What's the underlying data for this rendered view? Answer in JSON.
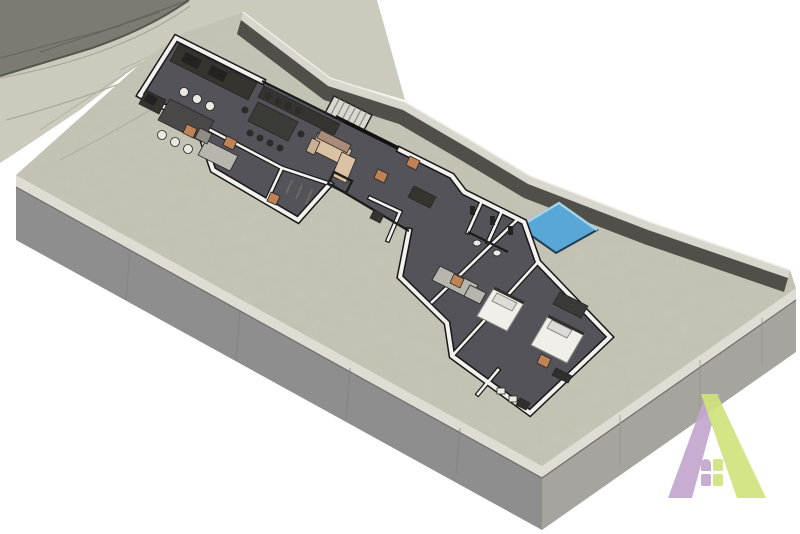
{
  "scene": {
    "type": "3d-floor-plan-render",
    "view": "axonometric",
    "elements": [
      "terrain-road",
      "terrain-slope",
      "driveway",
      "plot-slab",
      "boundary-wall",
      "house-floor-plan",
      "swimming-pool",
      "company-logo"
    ],
    "rooms": [
      "kitchen",
      "dining-area",
      "living-area",
      "pantry-utility",
      "glass-cellar",
      "stairs",
      "hall",
      "wc",
      "shower-rooms",
      "vanity-bathroom",
      "bedroom-1",
      "bedroom-2",
      "en-suite"
    ],
    "furniture": [
      "kitchen-counter",
      "kitchen-island",
      "bar-stools",
      "dining-table",
      "dining-chairs",
      "sofa",
      "coffee-table",
      "beds",
      "pillows",
      "benches",
      "wardrobe",
      "vanity-counter",
      "shower-columns",
      "toilets"
    ]
  },
  "colors": {
    "background": "#ffffff",
    "terrain_road": "#7b7a73",
    "terrain_light": "#cbcabc",
    "slab_top": "#c5c4b5",
    "slab_face_left": "#8f8e8f",
    "slab_face_right": "#a5a49f",
    "slab_lip": "#dedcd3",
    "wall_face": "#504f4a",
    "wall_top": "#d9d7cd",
    "house_floor": "#545359",
    "wall_white": "#f2f1ed",
    "wall_outline": "#171717",
    "counter_dark": "#35342f",
    "appliance_dark": "#222220",
    "furniture_grey": "#4a4947",
    "table_dark": "#3b3b38",
    "chair_dark": "#2c2c2a",
    "stool_seat": "#ebe8e1",
    "stairs_light": "#d9d7cf",
    "sofa_tan": "#dbc2a3",
    "sofa_accent": "#a98b78",
    "sofa_arm": "#c9b095",
    "cabinet_light": "#b7b5ae",
    "cabinet_grey": "#8e8c85",
    "glass_dark": "#47464c",
    "bed_white": "#f0efe9",
    "pillow": "#dcdbd5",
    "bench_dark": "#2f2f2d",
    "wardrobe_dark": "#3a3a37",
    "fixture_white": "#eceae4",
    "door_orange": "#c08355",
    "pool_water": "#58a7d6",
    "logo_purple": "#c2a7ce",
    "logo_green": "#d0e37c"
  }
}
